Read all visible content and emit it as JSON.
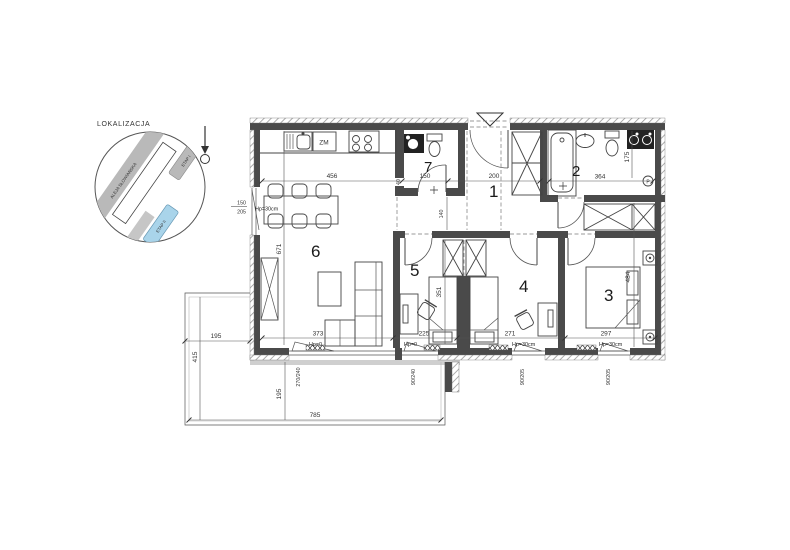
{
  "inset": {
    "title": "LOKALIZACJA",
    "street": "ALEJA SŁOWIAŃSKA",
    "etap_i": "ETAP I",
    "etap_ii": "ETAP II"
  },
  "rooms": {
    "r1": "1",
    "r2": "2",
    "r3": "3",
    "r4": "4",
    "r5": "5",
    "r6": "6",
    "r7": "7"
  },
  "kitchen": {
    "dishwasher": "ZM"
  },
  "bath": {
    "panel": "P"
  },
  "sill_labels": {
    "kitchen": "Hp=30cm",
    "living": "Hp=0",
    "room5": "Hp=0",
    "room4": "Hp=30cm",
    "room3": "Hp=30cm"
  },
  "dims": {
    "top_living": "456",
    "top_wc": "150",
    "top_hall": "200",
    "bath_w": "364",
    "bath_h": "175",
    "living_h": "671",
    "wall_niche": "40",
    "corridor": "140",
    "bottom_living": "373",
    "bottom_r5": "225",
    "bottom_r4": "271",
    "bottom_r3": "297",
    "r5_h": "351",
    "r3_h": "484",
    "terrace_w": "195",
    "terrace_left": "415",
    "terrace_depth": "195",
    "terrace_bottom": "785",
    "win_kitchen_w": "150",
    "win_kitchen_h": "205",
    "win_living": "270/240",
    "win_r5": "90/240",
    "win_r4": "90/205",
    "win_r3": "90/205"
  },
  "colors": {
    "wall": "#4a4a4a",
    "highlight_building": "#a9d4ea",
    "building_gray": "#b9b9b9"
  }
}
